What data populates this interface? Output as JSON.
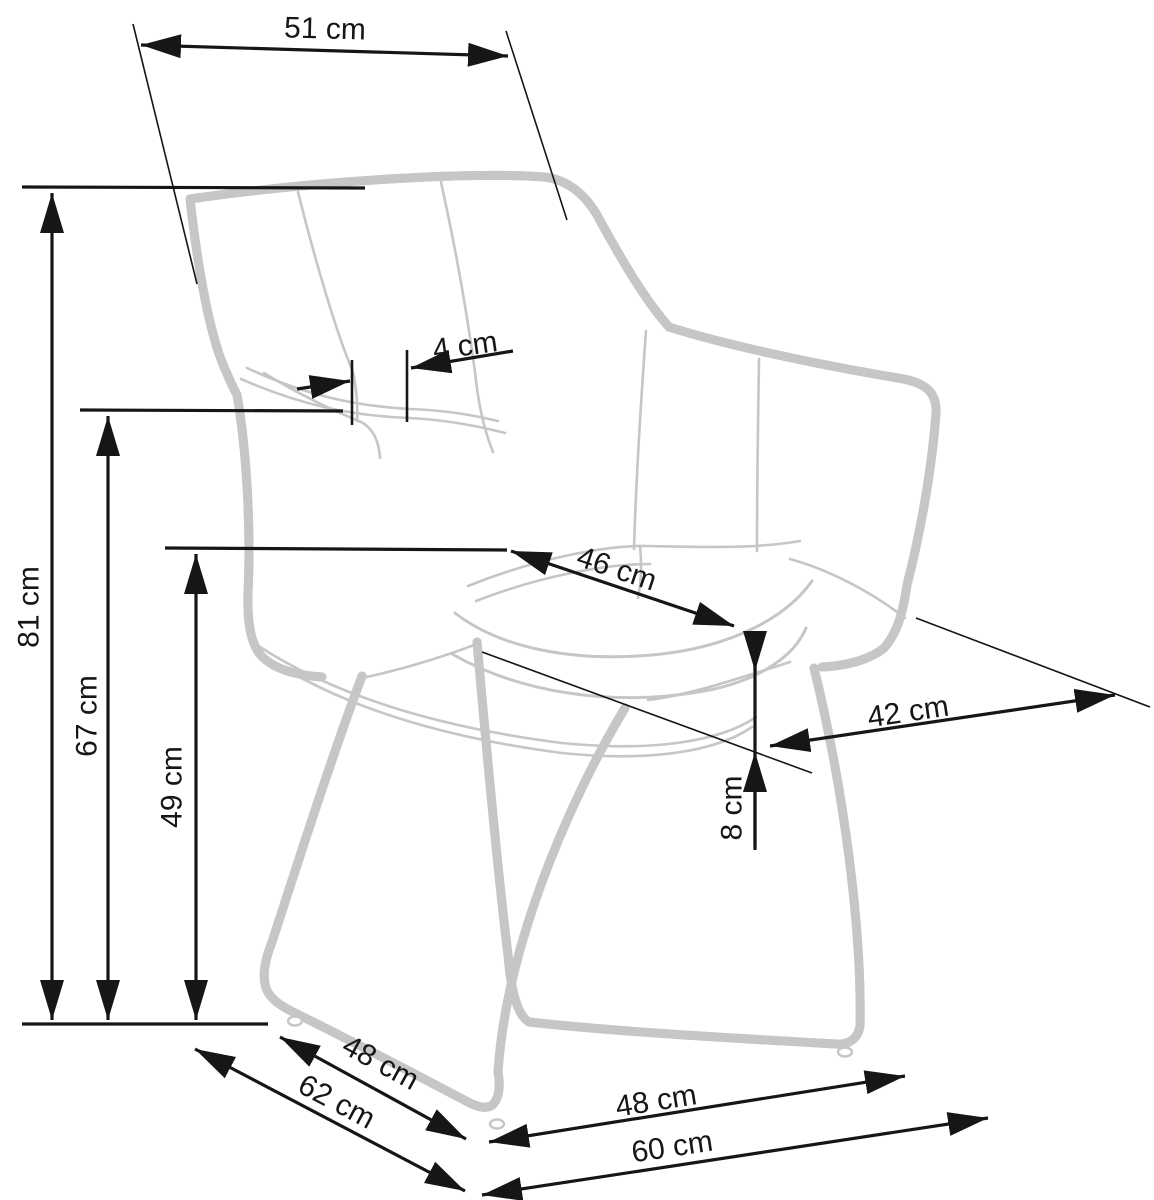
{
  "diagram": {
    "subject": "armchair-wireframe",
    "unit": "cm",
    "colors": {
      "dimension_line": "#161616",
      "chair_outline": "#c6c6c6",
      "background": "#ffffff"
    },
    "dimensions": [
      {
        "id": "backrest-top-width",
        "value": 51,
        "label": "51 cm"
      },
      {
        "id": "total-height",
        "value": 81,
        "label": "81 cm"
      },
      {
        "id": "armrest-height",
        "value": 67,
        "label": "67 cm"
      },
      {
        "id": "seat-height",
        "value": 49,
        "label": "49 cm"
      },
      {
        "id": "armrest-thickness",
        "value": 4,
        "label": "4 cm"
      },
      {
        "id": "seat-depth",
        "value": 46,
        "label": "46 cm"
      },
      {
        "id": "seat-width",
        "value": 42,
        "label": "42 cm"
      },
      {
        "id": "cushion-thickness",
        "value": 8,
        "label": "8 cm"
      },
      {
        "id": "base-side-depth",
        "value": 48,
        "label": "48 cm"
      },
      {
        "id": "base-total-depth",
        "value": 62,
        "label": "62 cm"
      },
      {
        "id": "base-front-width",
        "value": 48,
        "label": "48 cm"
      },
      {
        "id": "base-total-width",
        "value": 60,
        "label": "60 cm"
      }
    ]
  }
}
